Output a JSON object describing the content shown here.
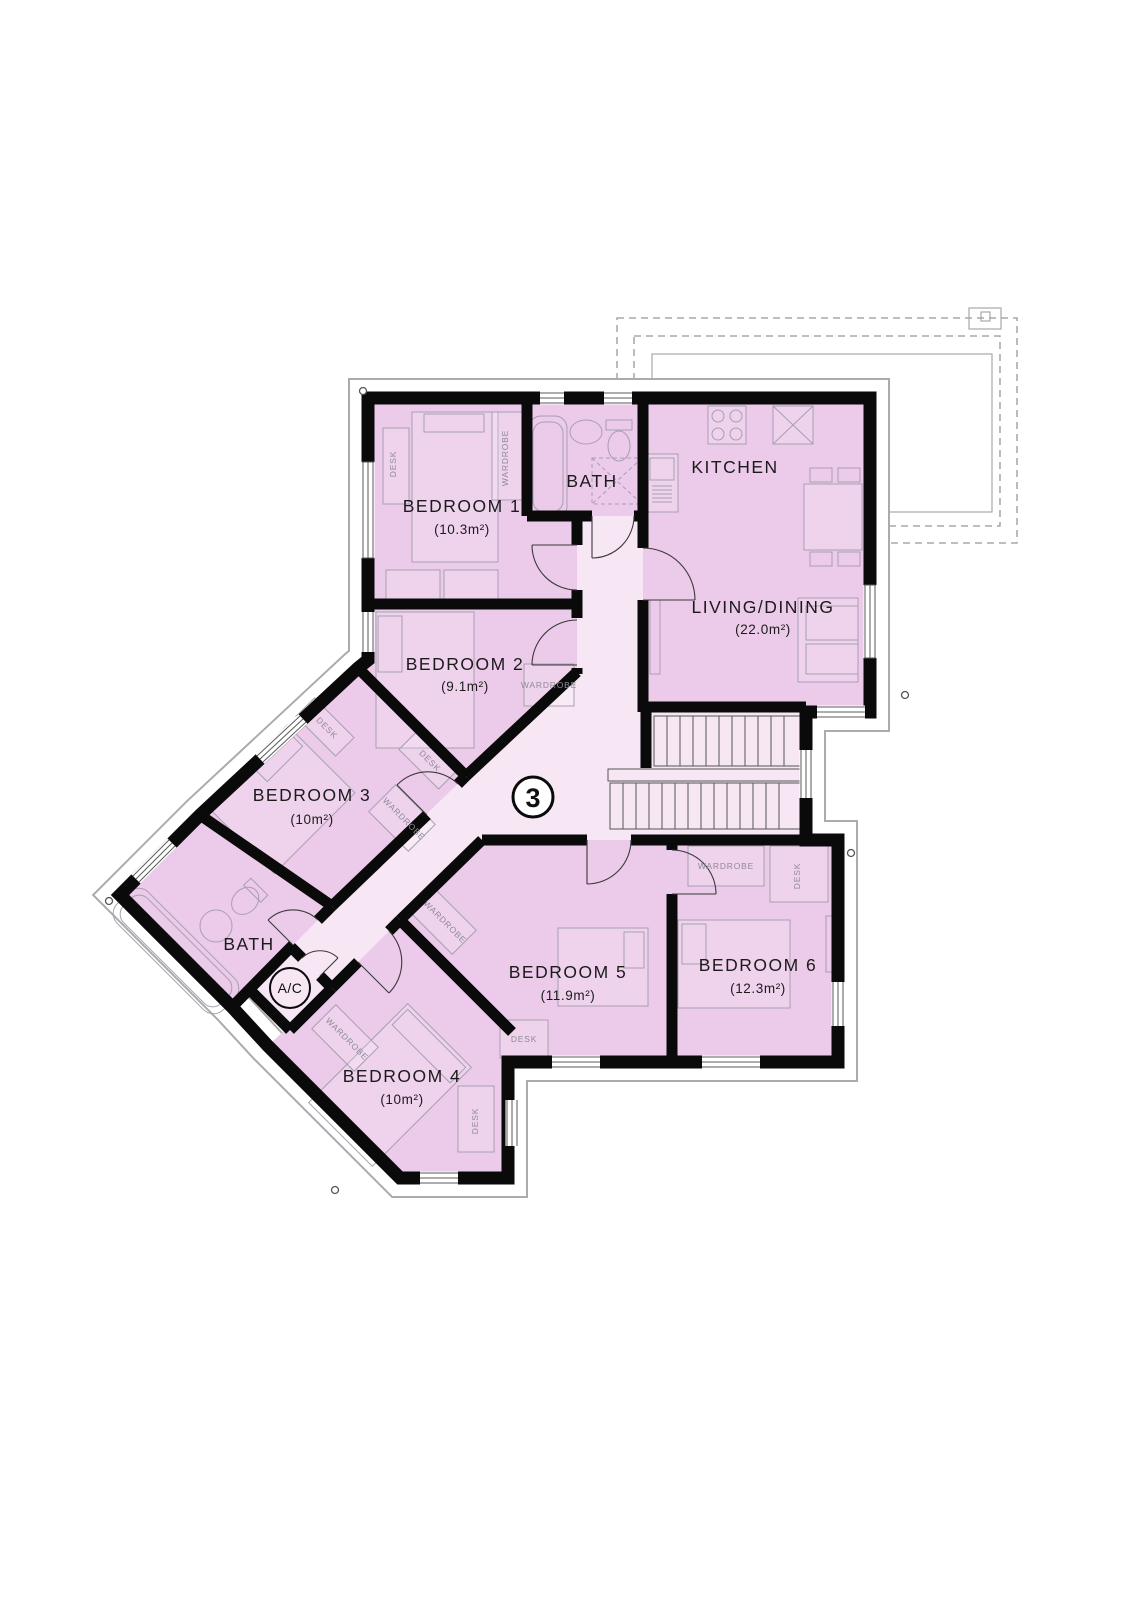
{
  "plan": {
    "flat_number": "3",
    "rooms": {
      "bedroom1": {
        "name": "BEDROOM 1",
        "area": "(10.3m²)"
      },
      "bedroom2": {
        "name": "BEDROOM 2",
        "area": "(9.1m²)"
      },
      "bedroom3": {
        "name": "BEDROOM 3",
        "area": "(10m²)"
      },
      "bedroom4": {
        "name": "BEDROOM 4",
        "area": "(10m²)"
      },
      "bedroom5": {
        "name": "BEDROOM 5",
        "area": "(11.9m²)"
      },
      "bedroom6": {
        "name": "BEDROOM 6",
        "area": "(12.3m²)"
      },
      "living": {
        "name": "LIVING/DINING",
        "area": "(22.0m²)"
      },
      "kitchen": {
        "name": "KITCHEN"
      },
      "bath_upper": {
        "name": "BATH"
      },
      "bath_lower": {
        "name": "BATH"
      },
      "ac": {
        "name": "A/C"
      }
    },
    "furniture_labels": {
      "desk": "DESK",
      "wardrobe": "WARDROBE"
    },
    "colors": {
      "room_fill": "#eccae9",
      "hall_fill": "#f7e7f5",
      "wall": "#0a0a0a"
    }
  }
}
